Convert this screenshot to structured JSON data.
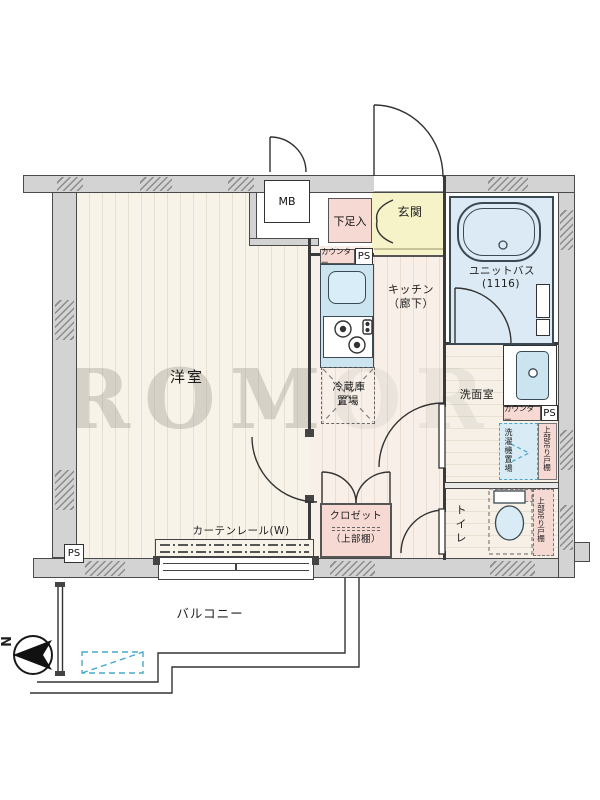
{
  "plan_type": "floorplan",
  "watermark": "ROM",
  "watermark_faint": "OR",
  "compass": {
    "north": "N"
  },
  "labels": {
    "living": "洋室",
    "balcony": "バルコニー",
    "genkan": "玄関",
    "kitchen1": "キッチン",
    "kitchen2": "（廊下）",
    "washroom": "洗面室",
    "toilet": "トイレ",
    "unit_bath": "ユニットバス",
    "unit_bath_size": "(1116)",
    "mb": "MB",
    "shoe_cabinet": "下足入",
    "counter_kitchen": "カウンター",
    "counter_washroom": "カウンター",
    "ps_kitchen": "PS",
    "ps_washroom": "PS",
    "ps_balcony": "PS",
    "fridge1": "冷蔵庫",
    "fridge2": "置場",
    "laundry": "洗濯機置場",
    "cupboard_washroom": "上部吊り戸棚",
    "cupboard_toilet": "上部吊り戸棚",
    "closet": "クロゼット",
    "closet_shelf": "（上部棚）",
    "curtain_rail": "カーテンレール(W)"
  },
  "colors": {
    "wall": "#d3d3d3",
    "wall_edge": "#4a4a4a",
    "floor_wood": "#f7f3e8",
    "corridor": "#f8f0e8",
    "bath_blue": "#dbeaf4",
    "fixture_blue": "#cce4f0",
    "genkan_yellow": "#f6f3c8",
    "cabinet_pink": "#f7d9d3",
    "dashed_blue": "#4aa5ca",
    "linework": "#333333"
  }
}
